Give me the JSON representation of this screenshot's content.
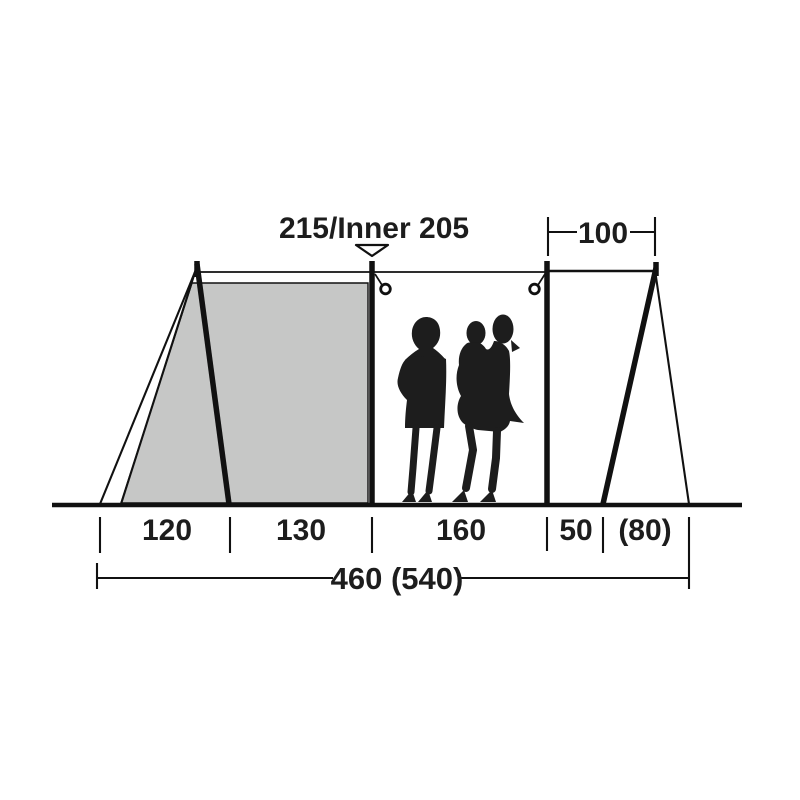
{
  "colors": {
    "line": "#111111",
    "ink": "#1d1d1d",
    "inner_fill": "#c6c7c6",
    "silhouette": "#1d1d1d",
    "background": "#ffffff"
  },
  "icons": {
    "height_marker": "down-triangle-icon",
    "pole_attachment": "ring-icon"
  },
  "diagram": {
    "type": "tent-side-profile-dimensions",
    "height_label": "215/Inner 205",
    "rear_depth_label": "100",
    "floor_sections": [
      "120",
      "130",
      "160",
      "50",
      "(80)"
    ],
    "total_length_label": "460 (540)"
  }
}
